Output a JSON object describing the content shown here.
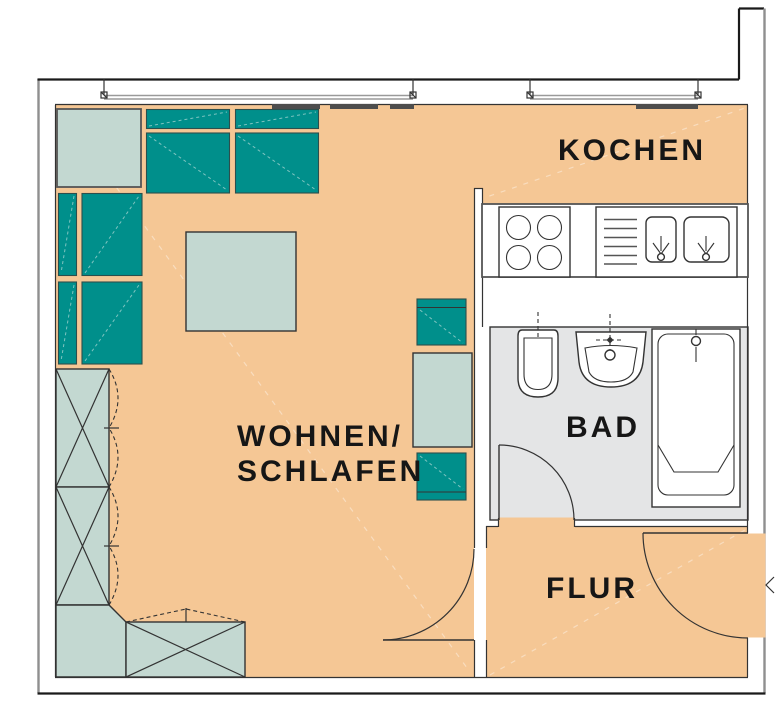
{
  "plan": {
    "type": "apartment-floor-plan",
    "labels": {
      "kitchen": "KOCHEN",
      "living_line1": "WOHNEN/",
      "living_line2": "SCHLAFEN",
      "bath": "BAD",
      "hall": "FLUR"
    },
    "colors": {
      "floor": "#F5C795",
      "furniture_teal": "#008F8B",
      "furniture_light": "#C3D8D1",
      "bath_floor": "#E4E5E6",
      "wall_dark": "#1A1A1A",
      "wall_gray": "#8F8F8F",
      "line": "#333333",
      "radiator": "#4D4D4D",
      "teal_dash": "#7FC4C0"
    }
  }
}
